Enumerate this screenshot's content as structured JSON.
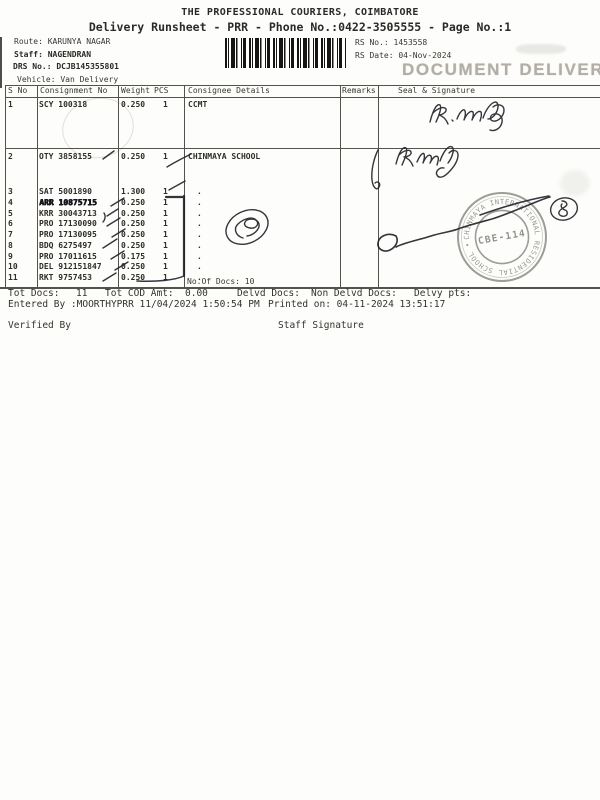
{
  "header": {
    "title": "THE PROFESSIONAL COURIERS, COIMBATORE",
    "subtitle": "Delivery Runsheet - PRR - Phone No.:0422-3505555 - Page No.:1",
    "route": "Route: KARUNYA NAGAR",
    "staff": "Staff: NAGENDRAN",
    "drs_no": "DRS No.: DCJB145355801",
    "vehicle": "Vehicle: Van Delivery",
    "rs_no": "RS No.: 1453558",
    "rs_date": "RS Date: 04-Nov-2024"
  },
  "stamps": {
    "document_delivery": "DOCUMENT DELIVERY",
    "round_stamp": {
      "rim_text": "CHINMAYA INTERNATIONAL RESIDENTIAL SCHOOL •",
      "center_text": "CBE-114"
    }
  },
  "table": {
    "headers": {
      "sno": "S No",
      "consignment": "Consignment No",
      "weight": "Weight",
      "pcs": "PCS",
      "consignee": "Consignee Details",
      "remarks": "Remarks",
      "seal": "Seal & Signature"
    },
    "rows": [
      {
        "sno": "1",
        "consignment": "SCY 100318",
        "weight": "0.250",
        "pcs": "1",
        "consignee": "CCMT"
      },
      {
        "sno": "2",
        "consignment": "OTY 3858155",
        "weight": "0.250",
        "pcs": "1",
        "consignee": "CHINMAYA SCHOOL"
      },
      {
        "sno": "3",
        "consignment": "SAT 5001890",
        "weight": "1.300",
        "pcs": "1",
        "consignee": "."
      },
      {
        "sno": "4",
        "consignment": "ARR 10875715",
        "weight": "0.250",
        "pcs": "1",
        "consignee": "."
      },
      {
        "sno": "5",
        "consignment": "KRR 30043713",
        "weight": "0.250",
        "pcs": "1",
        "consignee": "."
      },
      {
        "sno": "6",
        "consignment": "PRO 17130090",
        "weight": "0.250",
        "pcs": "1",
        "consignee": "."
      },
      {
        "sno": "7",
        "consignment": "PRO 17130095",
        "weight": "0.250",
        "pcs": "1",
        "consignee": "."
      },
      {
        "sno": "8",
        "consignment": "BDQ 6275497",
        "weight": "0.250",
        "pcs": "1",
        "consignee": "."
      },
      {
        "sno": "9",
        "consignment": "PRO 17011615",
        "weight": "0.175",
        "pcs": "1",
        "consignee": "."
      },
      {
        "sno": "10",
        "consignment": "DEL 912151847",
        "weight": "0.250",
        "pcs": "1",
        "consignee": "."
      },
      {
        "sno": "11",
        "consignment": "RKT 9757453",
        "weight": "0.250",
        "pcs": "1",
        "consignee": "."
      }
    ],
    "no_of_docs": "No.Of Docs: 10"
  },
  "footer": {
    "tot_docs_label": "Tot Docs:",
    "tot_docs_value": "11",
    "tot_cod_label": "Tot COD Amt:",
    "tot_cod_value": "0.00",
    "delvd_docs_label": "Delvd Docs:",
    "non_delvd_docs_label": "Non Delvd Docs:",
    "delvy_pts_label": "Delvy pts:",
    "entered_by": "Entered By :MOORTHYPRR 11/04/2024 1:50:54 PM",
    "printed_on": "Printed on: 04-11-2024 13:51:17",
    "verified_by": "Verified By",
    "staff_signature": "Staff Signature"
  },
  "colors": {
    "ink": "#33312c",
    "pen": "#23232a",
    "stamp_gray": "#90908a",
    "document_delivery_gray": "#a5a198"
  }
}
